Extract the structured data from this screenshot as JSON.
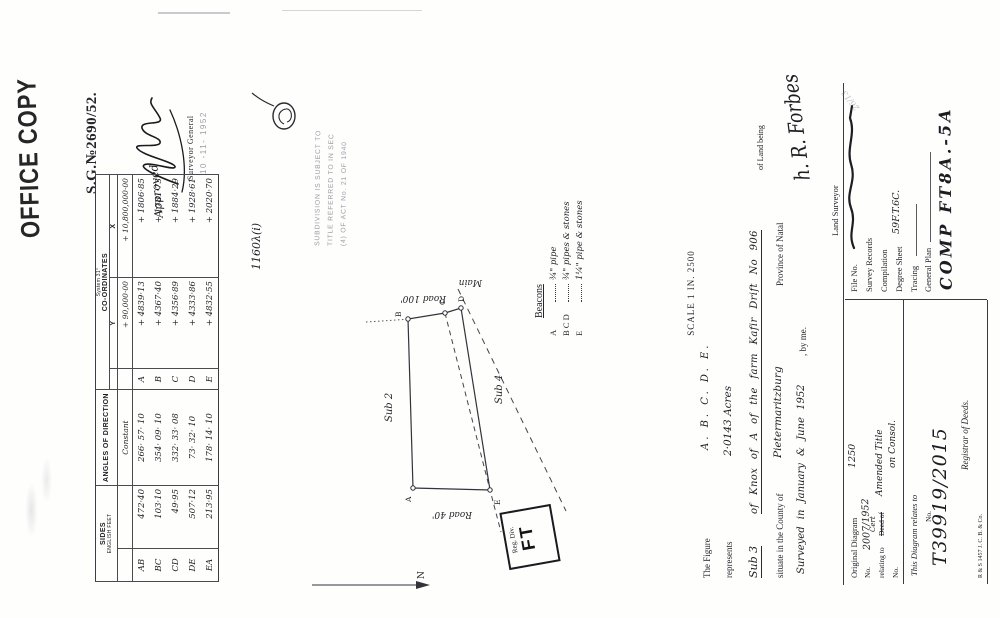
{
  "stamps": {
    "office_copy": "OFFICE COPY",
    "sg_number": "S.G.№2690/52.",
    "approved_label": "Approved",
    "surveyor_general": "Surveyor General",
    "approval_date": "10 -11- 1952",
    "act_line1": "SUBDIVISION IS SUBJECT TO",
    "act_line2": "TITLE REFERRED TO IN SEC",
    "act_line3": "(4) OF ACT No. 21 OF 1940",
    "reference_code": "1160λ(i)",
    "reg_div_label": "Reg. Div.",
    "reg_div_value": "FT",
    "corner_note": "26/13"
  },
  "survey_table": {
    "sides_header": "SIDES",
    "sides_subheader": "ENGLISH FEET",
    "angles_header": "ANGLES OF DIRECTION",
    "coords_system": "System 31°",
    "coords_header": "CO-ORDINATES",
    "y_header": "Y",
    "x_header": "X",
    "constant_label": "Constant",
    "constant_y": "+ 90,000·00",
    "constant_x": "+ 10,800,000·00",
    "rows": [
      {
        "side": "AB",
        "length": "472·40",
        "angle": "266· 57· 10",
        "pt": "A",
        "y": "+ 4839·13",
        "x": "+ 1806·85"
      },
      {
        "side": "BC",
        "length": "103·10",
        "angle": "354· 09· 10",
        "pt": "B",
        "y": "+ 4367·40",
        "x": "+ 1781·73"
      },
      {
        "side": "CD",
        "length": "49·95",
        "angle": "332· 33· 08",
        "pt": "C",
        "y": "+ 4356·89",
        "x": "+ 1884·29"
      },
      {
        "side": "DE",
        "length": "507·12",
        "angle": "73· 32· 10",
        "pt": "D",
        "y": "+ 4333·86",
        "x": "+ 1928·61"
      },
      {
        "side": "EA",
        "length": "213·95",
        "angle": "178· 14· 10",
        "pt": "E",
        "y": "+ 4832·55",
        "x": "+ 2020·70"
      }
    ]
  },
  "diagram": {
    "vertices": [
      "A",
      "B",
      "C",
      "D",
      "E"
    ],
    "road_right": "Road 100'",
    "road_main": "Main",
    "road_left": "Road 40'",
    "neighbor_top": "Sub 2",
    "neighbor_bottom": "Sub 4",
    "north_label": "N"
  },
  "beacons": {
    "title": "Beacons",
    "rows": [
      {
        "points": "A",
        "desc": "¾\" pipe"
      },
      {
        "points": "B C D",
        "desc": "¾\" pipes & stones"
      },
      {
        "points": "E",
        "desc": "1¼\" pipe & stones"
      }
    ]
  },
  "description": {
    "scale_note": "SCALE 1 IN. 2500",
    "figure_label": "The Figure",
    "figure_points": "A. B. C. D. E.",
    "represents_label": "represents",
    "extent": "2·0143 Acres",
    "land_being": "of Land being",
    "sub_label": "Sub 3",
    "property": "of Knox of A of the farm Kafir Drift  No 906",
    "situate_label": "situate in the County of",
    "county": "Pietermaritzburg",
    "province": "Province of Natal",
    "surveyed_line": "Surveyed in January & June 1952",
    "by_me": ", by me.",
    "signature": "h. R. Forbes",
    "surveyor_title": "Land Surveyor"
  },
  "records_panel": {
    "file_no_label": "File No.",
    "survey_records": "Survey Records",
    "compilation": "Compilation",
    "degree_sheet_label": "Degree Sheet",
    "degree_sheet_value": "59F.T.6C.",
    "tracing": "Tracing",
    "general_plan": "General Plan",
    "comp_code": "COMP FT8A.-5A"
  },
  "original_diagram": {
    "title": "Original Diagram",
    "title_note": "1250",
    "no_label": "No.",
    "no_value": "2007/1952",
    "relating_label": "relating to",
    "struck_text": "Deed of",
    "replacement": "Cert",
    "amended_text": "Amended Title",
    "consol_text": "on Consol.",
    "no2_label": "No."
  },
  "relates_panel": {
    "title": "This Diagram relates to",
    "no_label": "No.",
    "deed_number": "T39919/2015",
    "registrar": "Registrar of Deeds.",
    "print_code": "R & S 1457   J. C. B. & Co."
  }
}
